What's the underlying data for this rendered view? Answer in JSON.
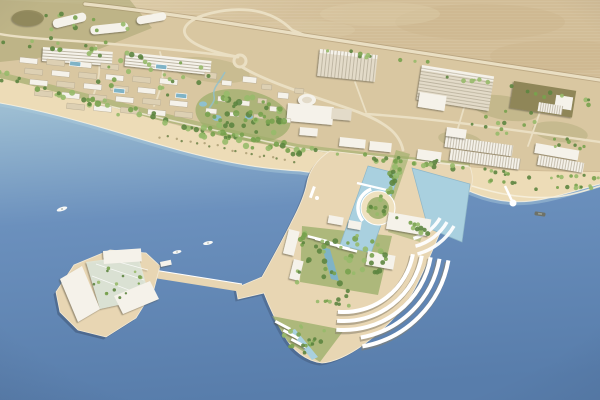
{
  "colors": {
    "sea_top": "#9cbdd2",
    "sea_mid": "#6b90bd",
    "sea_deep": "#587dab",
    "shallow": "#aecbdc",
    "basin": "#a9d0df",
    "pond": "#8fc0cf",
    "pool": "#7fb3c6",
    "desert": "#d2bd97",
    "desert_dark": "#c6ae83",
    "desert_light": "#e0d1ae",
    "ground": "#d9c7a1",
    "scrub": "#a4a26d",
    "green": "#9aad68",
    "beach": "#eddcb7",
    "platform": "#e8d6b3",
    "plaza": "#efe1bf",
    "road": "#eadfc3",
    "promenade": "#f6efdd",
    "white": "#f5f2ea",
    "off_white": "#e3dbc9",
    "stripe": "#b2a995",
    "tan_bld": "#ddd0b3",
    "olive_bld": "#8f8659",
    "glass": "#dfe7db",
    "tree_dark": "#5d8540",
    "tree_mid": "#78a24e",
    "tree_light": "#97ba6a",
    "palm": "#7e8f57",
    "boat_white": "#f7f8f6",
    "boat_dark": "#6e7268",
    "edge_white": "#f8f3e4"
  },
  "objects": {
    "boats": 4
  }
}
